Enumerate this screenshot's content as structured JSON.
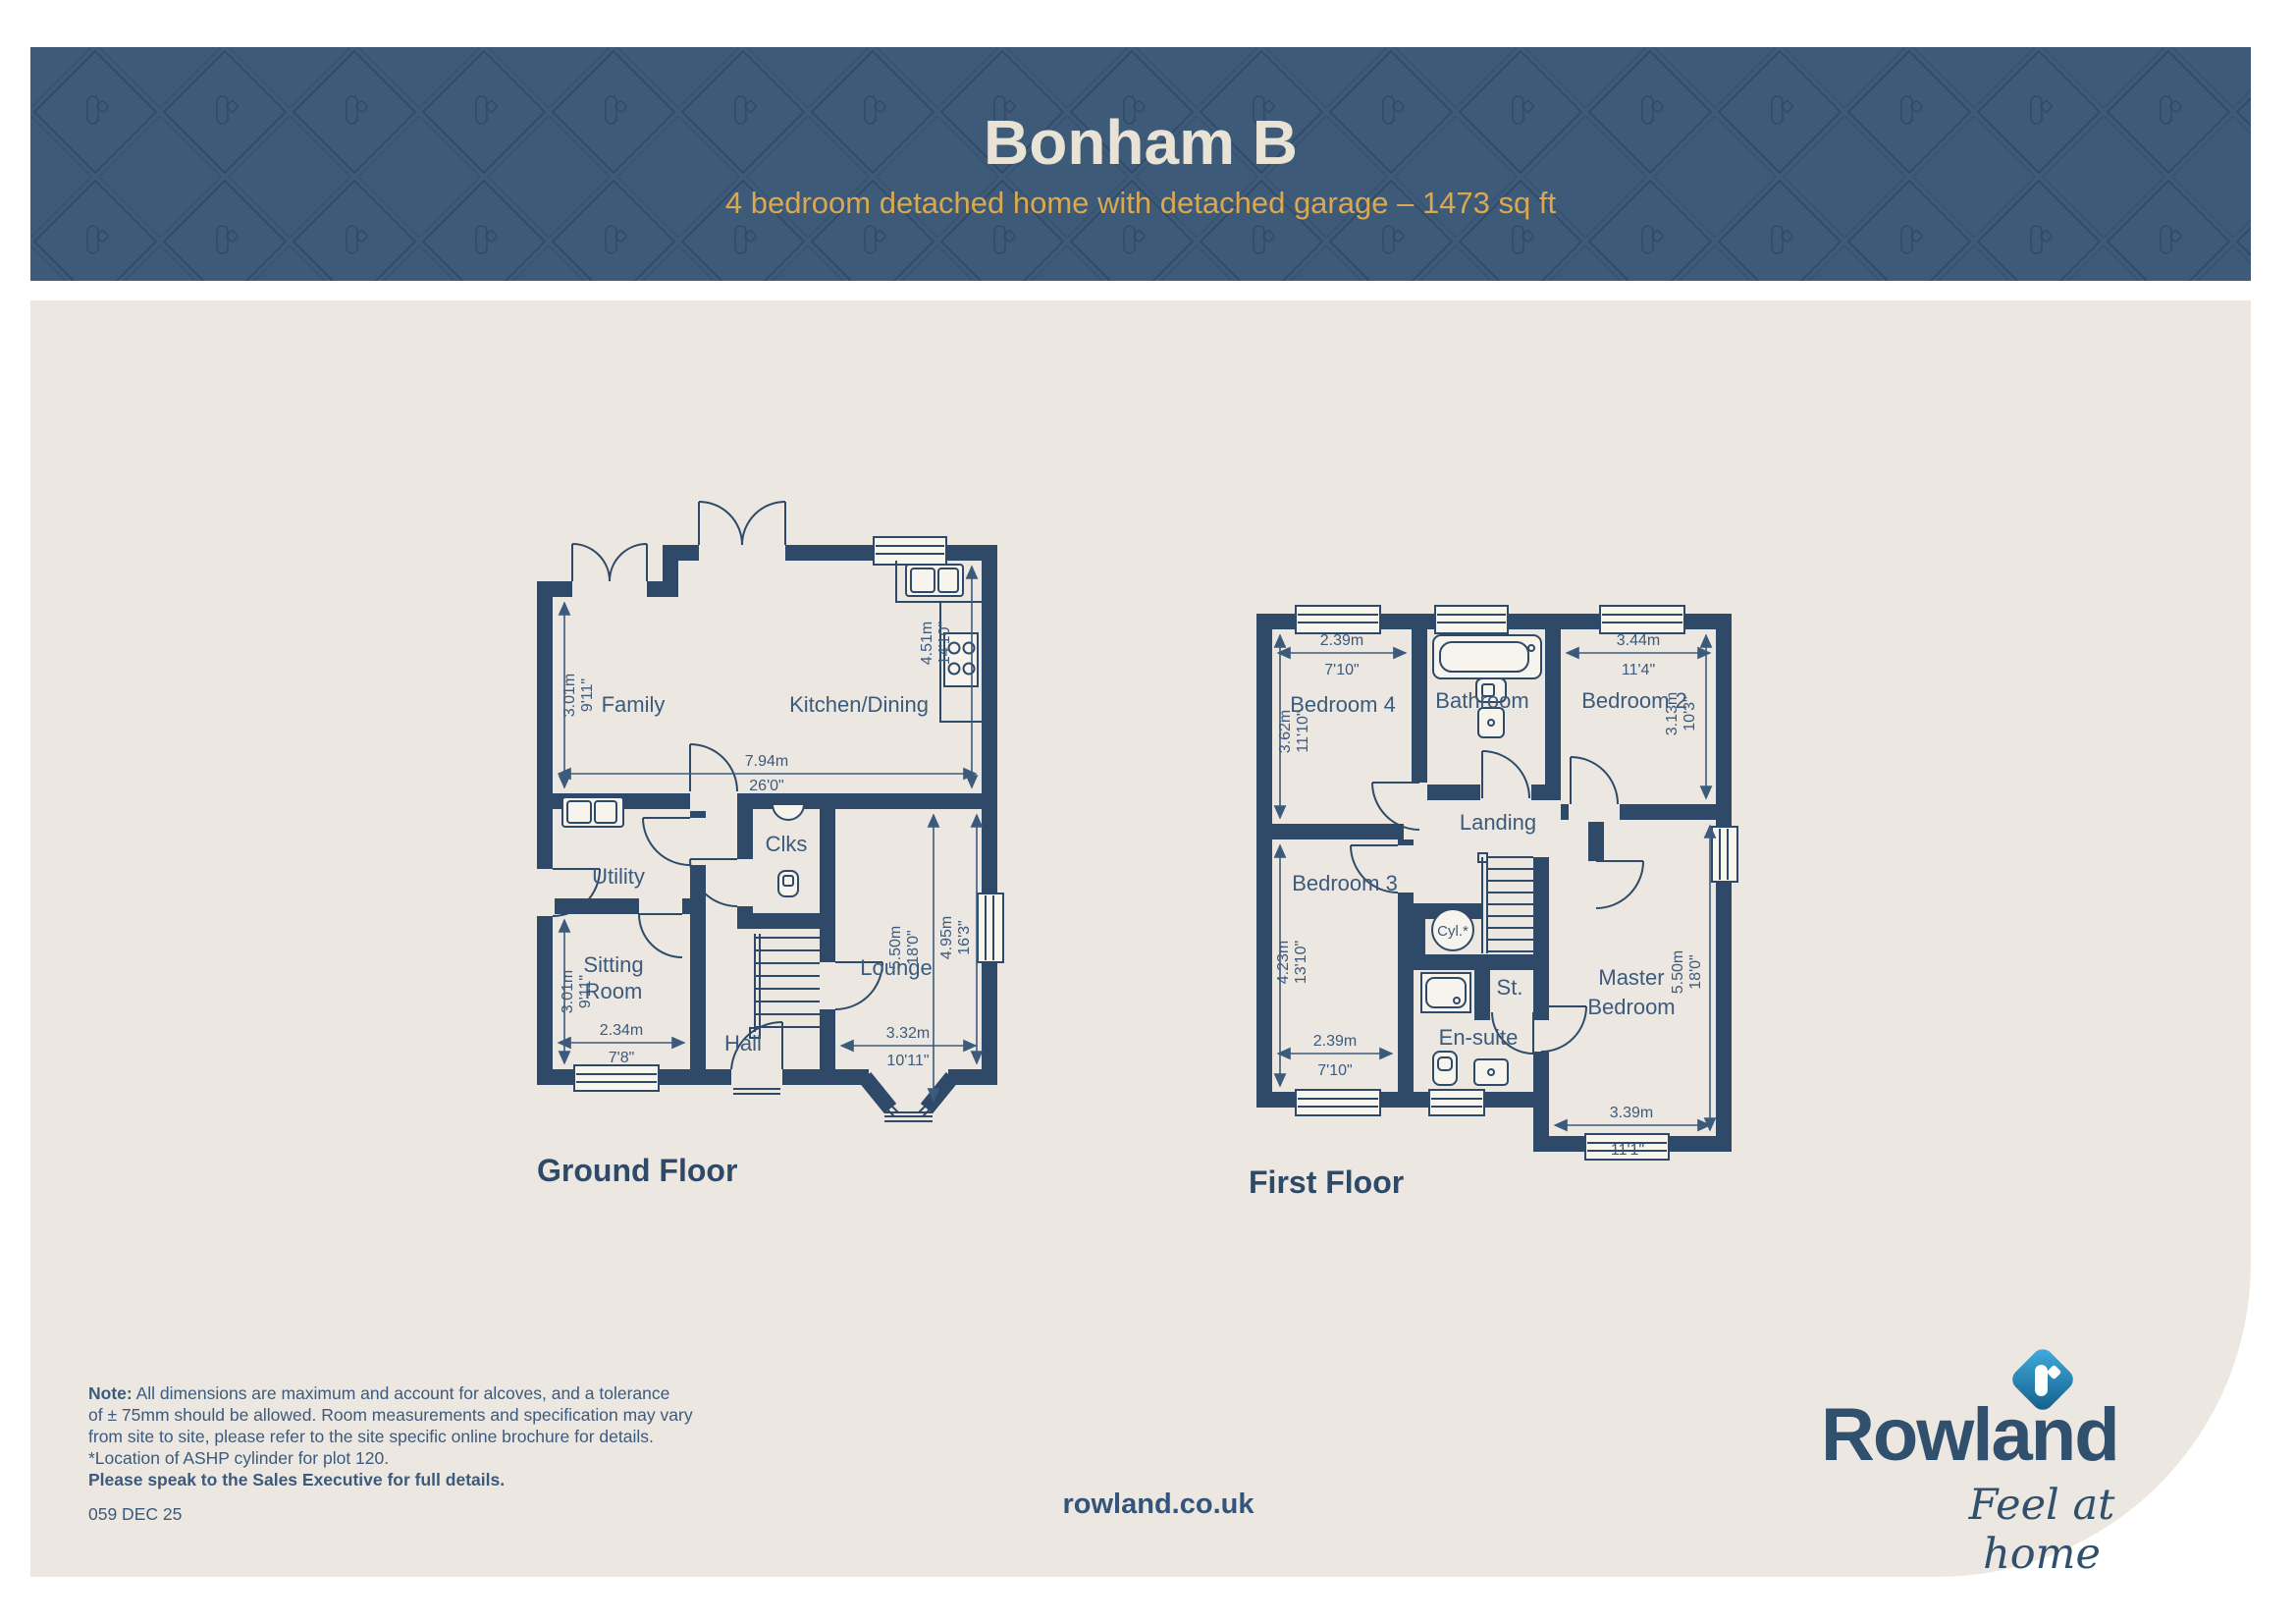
{
  "header": {
    "title": "Bonham B",
    "subtitle": "4 bedroom detached home with detached garage – 1473 sq ft"
  },
  "gf": {
    "floor_label": "Ground Floor",
    "rooms": {
      "family": "Family",
      "kitchen": "Kitchen/Dining",
      "utility": "Utility",
      "clks": "Clks",
      "sitting_l1": "Sitting",
      "sitting_l2": "Room",
      "hall": "Hall",
      "lounge": "Lounge"
    },
    "dims": {
      "family_v": {
        "m": "3.01m",
        "ft": "9'11\""
      },
      "overall_w": {
        "m": "7.94m",
        "ft": "26'0\""
      },
      "kitchen_v": {
        "m": "4.51m",
        "ft": "14'10\""
      },
      "sitting_v": {
        "m": "3.01m",
        "ft": "9'11\""
      },
      "sitting_h": {
        "m": "2.34m",
        "ft": "7'8\""
      },
      "lounge_v1": {
        "m": "5.50m",
        "ft": "18'0\""
      },
      "lounge_v2": {
        "m": "4.95m",
        "ft": "16'3\""
      },
      "lounge_h": {
        "m": "3.32m",
        "ft": "10'11\""
      }
    }
  },
  "ff": {
    "floor_label": "First Floor",
    "rooms": {
      "bed4": "Bedroom 4",
      "bathroom": "Bathroom",
      "bed2": "Bedroom 2",
      "landing": "Landing",
      "bed3": "Bedroom 3",
      "ensuite": "En-suite",
      "st": "St.",
      "cyl": "Cyl.*",
      "master_l1": "Master",
      "master_l2": "Bedroom"
    },
    "dims": {
      "bed4_h": {
        "m": "2.39m",
        "ft": "7'10\""
      },
      "bed4_v": {
        "m": "3.62m",
        "ft": "11'10\""
      },
      "bed2_h": {
        "m": "3.44m",
        "ft": "11'4\""
      },
      "bed2_v": {
        "m": "3.13m",
        "ft": "10'3\""
      },
      "bed3_v": {
        "m": "4.23m",
        "ft": "13'10\""
      },
      "bed3_h": {
        "m": "2.39m",
        "ft": "7'10\""
      },
      "master_v": {
        "m": "5.50m",
        "ft": "18'0\""
      },
      "master_h": {
        "m": "3.39m",
        "ft": "11'1\""
      }
    }
  },
  "footer": {
    "note_label": "Note:",
    "note_line1": " All dimensions are maximum and account for alcoves, and a tolerance",
    "note_line2": "of ± 75mm should be allowed. Room measurements and specification may vary",
    "note_line3": "from site to site, please refer to the site specific online brochure for details.",
    "note_line4": "*Location of ASHP cylinder for plot 120.",
    "note_line5": "Please speak to the Sales Executive for full details.",
    "ref": "059 DEC 25",
    "website": "rowland.co.uk"
  },
  "logo": {
    "brand": "Rowland",
    "tagline": "Feel at home"
  },
  "colors": {
    "header_bg": "#3d5a78",
    "wall_navy": "#2e4a68",
    "label_navy": "#3c5a7c",
    "beige": "#ece8e1",
    "gold": "#d9a851",
    "cream": "#e9e3d5",
    "logo_navy": "#31506e",
    "logo_gradient_start": "#41b1e3",
    "logo_gradient_end": "#135a86"
  }
}
